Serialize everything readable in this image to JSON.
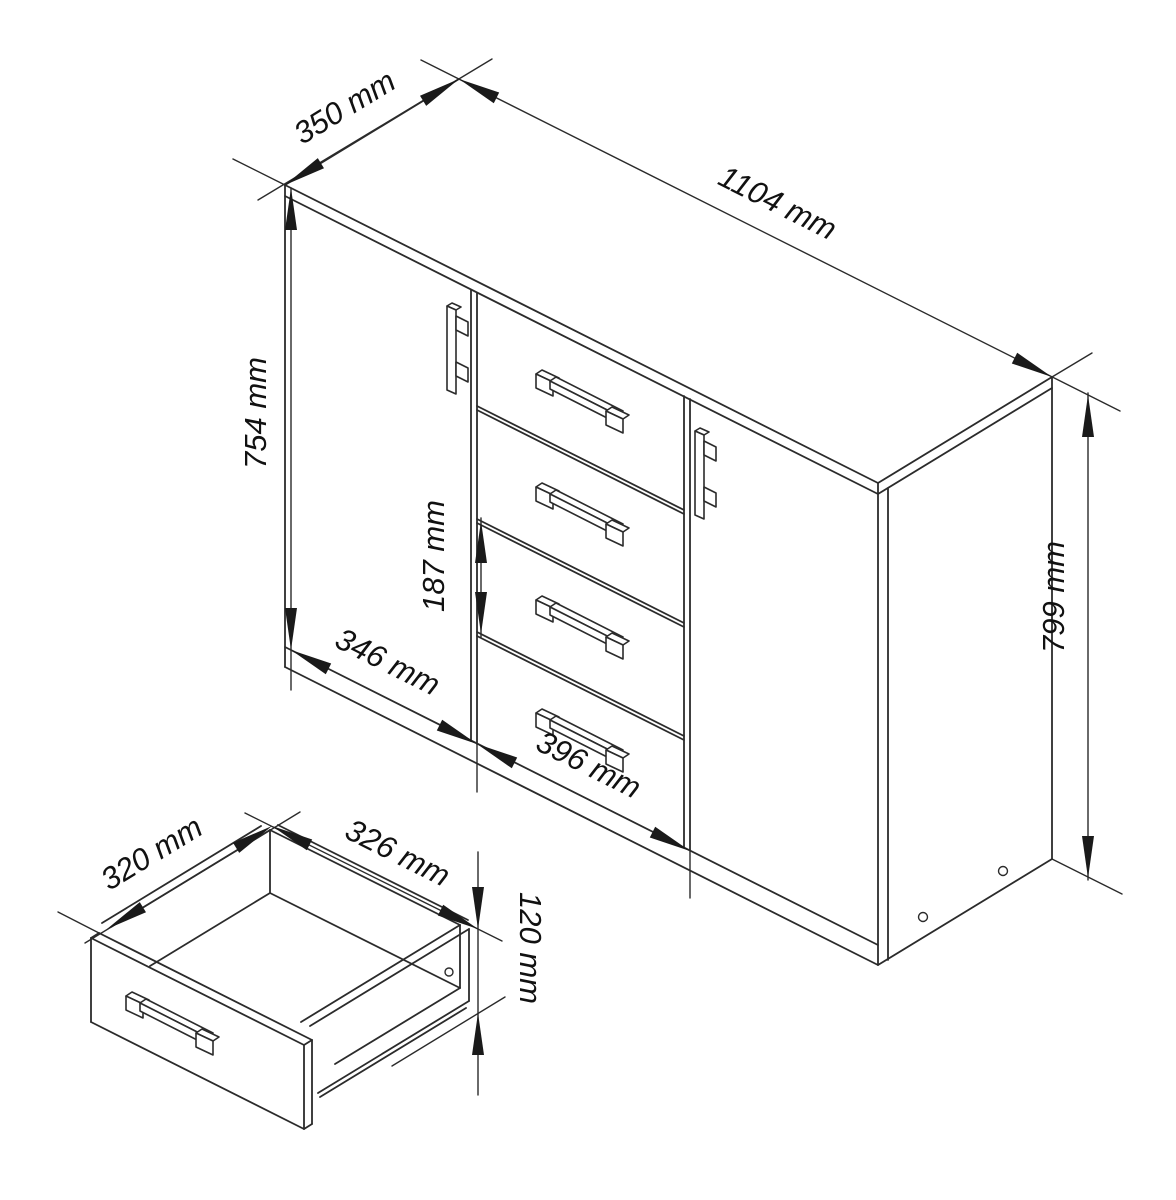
{
  "drawing": {
    "background": "#ffffff",
    "line_color": "#2b2b2b",
    "text_color": "#111111",
    "unit": "mm",
    "dimensions": {
      "depth": "350 mm",
      "width": "1104 mm",
      "door_height": "754 mm",
      "drawer_front_height": "187 mm",
      "left_door_width": "346 mm",
      "drawer_section_width": "396 mm",
      "total_height": "799 mm",
      "drawer_inner_depth": "320 mm",
      "drawer_inner_width": "326 mm",
      "drawer_inner_height": "120 mm"
    }
  }
}
